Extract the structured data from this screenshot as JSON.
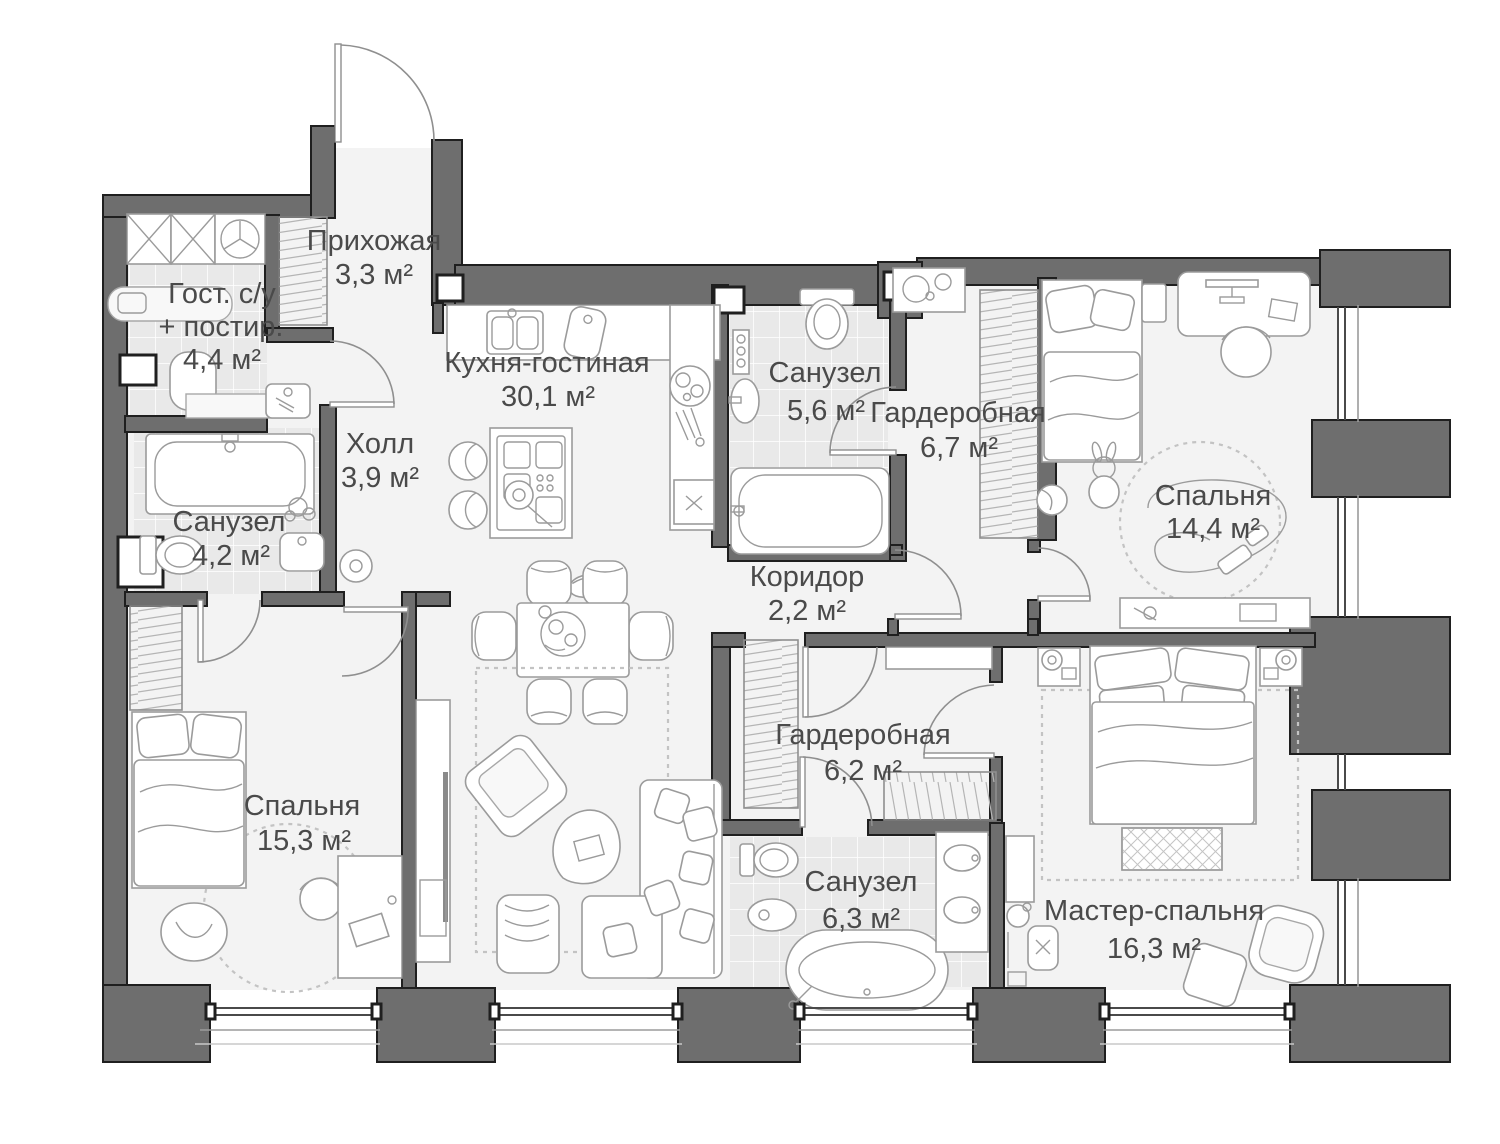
{
  "colors": {
    "wall": "#6e6e6e",
    "wall_outline": "#1f1f1f",
    "floor": "#f3f3f3",
    "tile_floor": "#e9e9e9",
    "furniture_line": "#9b9b9b",
    "label_text": "#4a4a4a"
  },
  "plan": {
    "rooms": [
      {
        "id": "hallway",
        "name": "Прихожая",
        "area": "3,3 м²"
      },
      {
        "id": "guest-wc",
        "name": "Гост. с/у",
        "name2": "+ постир.",
        "area": "4,4 м²"
      },
      {
        "id": "kitchen-living",
        "name": "Кухня-гостиная",
        "area": "30,1 м²"
      },
      {
        "id": "hall",
        "name": "Холл",
        "area": "3,9 м²"
      },
      {
        "id": "bathroom-4-2",
        "name": "Санузел",
        "area": "4,2 м²"
      },
      {
        "id": "bathroom-5-6",
        "name": "Санузел",
        "area": "5,6 м²"
      },
      {
        "id": "wardrobe-6-7",
        "name": "Гардеробная",
        "area": "6,7 м²"
      },
      {
        "id": "bedroom-14-4",
        "name": "Спальня",
        "area": "14,4 м²"
      },
      {
        "id": "corridor",
        "name": "Коридор",
        "area": "2,2 м²"
      },
      {
        "id": "wardrobe-6-2",
        "name": "Гардеробная",
        "area": "6,2 м²"
      },
      {
        "id": "bedroom-15-3",
        "name": "Спальня",
        "area": "15,3 м²"
      },
      {
        "id": "bathroom-6-3",
        "name": "Санузел",
        "area": "6,3 м²"
      },
      {
        "id": "master-bedroom",
        "name": "Мастер-спальня",
        "area": "16,3 м²"
      }
    ]
  }
}
